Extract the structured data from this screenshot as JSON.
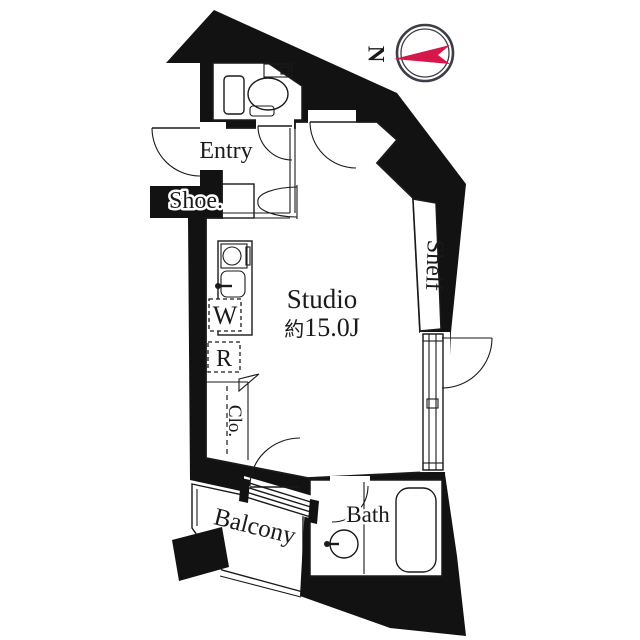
{
  "colors": {
    "wall": "#121212",
    "accent_red": "#d6174c",
    "compass_ring": "#3d3d48",
    "background": "#ffffff"
  },
  "compass": {
    "north_label": "N"
  },
  "rooms": {
    "studio": {
      "label": "Studio",
      "size_prefix": "約",
      "size_value": "15.0J"
    },
    "entry": {
      "label": "Entry"
    },
    "shoe_cabinet": {
      "label": "Shoe."
    },
    "washer": {
      "label": "W"
    },
    "refrigerator": {
      "label": "R"
    },
    "closet": {
      "label": "Clo."
    },
    "shelf": {
      "label": "Shelf"
    },
    "bath": {
      "label": "Bath"
    },
    "balcony": {
      "label": "Balcony"
    }
  }
}
